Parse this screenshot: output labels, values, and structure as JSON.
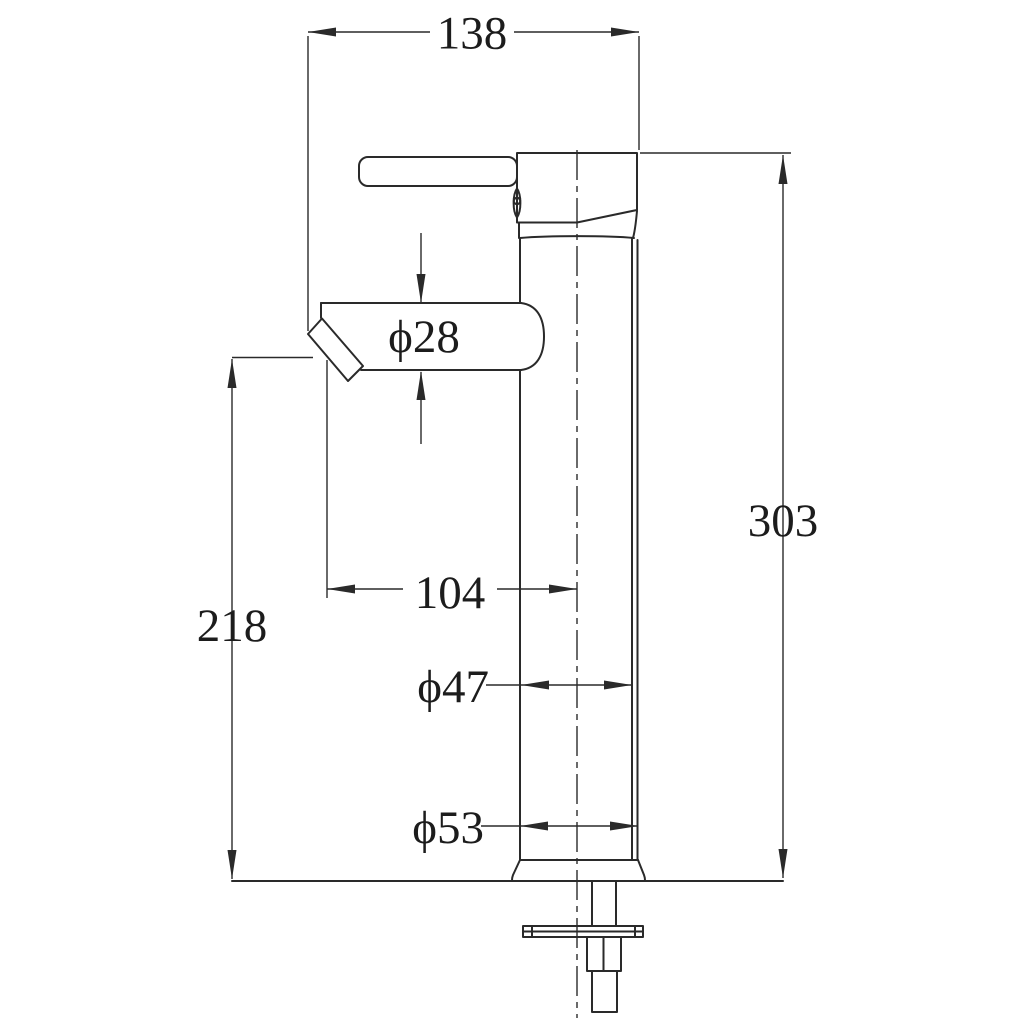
{
  "drawing": {
    "type": "technical-dimension-drawing",
    "subject": "tall vessel basin mixer faucet, side elevation",
    "background_color": "#ffffff",
    "line_color": "#2a2a2a",
    "units": "mm",
    "dimensions": {
      "top_width": "138",
      "spout_diameter": "ϕ28",
      "spout_reach": "104",
      "spout_height": "218",
      "overall_height": "303",
      "body_diameter": "ϕ47",
      "base_diameter": "ϕ53"
    }
  }
}
